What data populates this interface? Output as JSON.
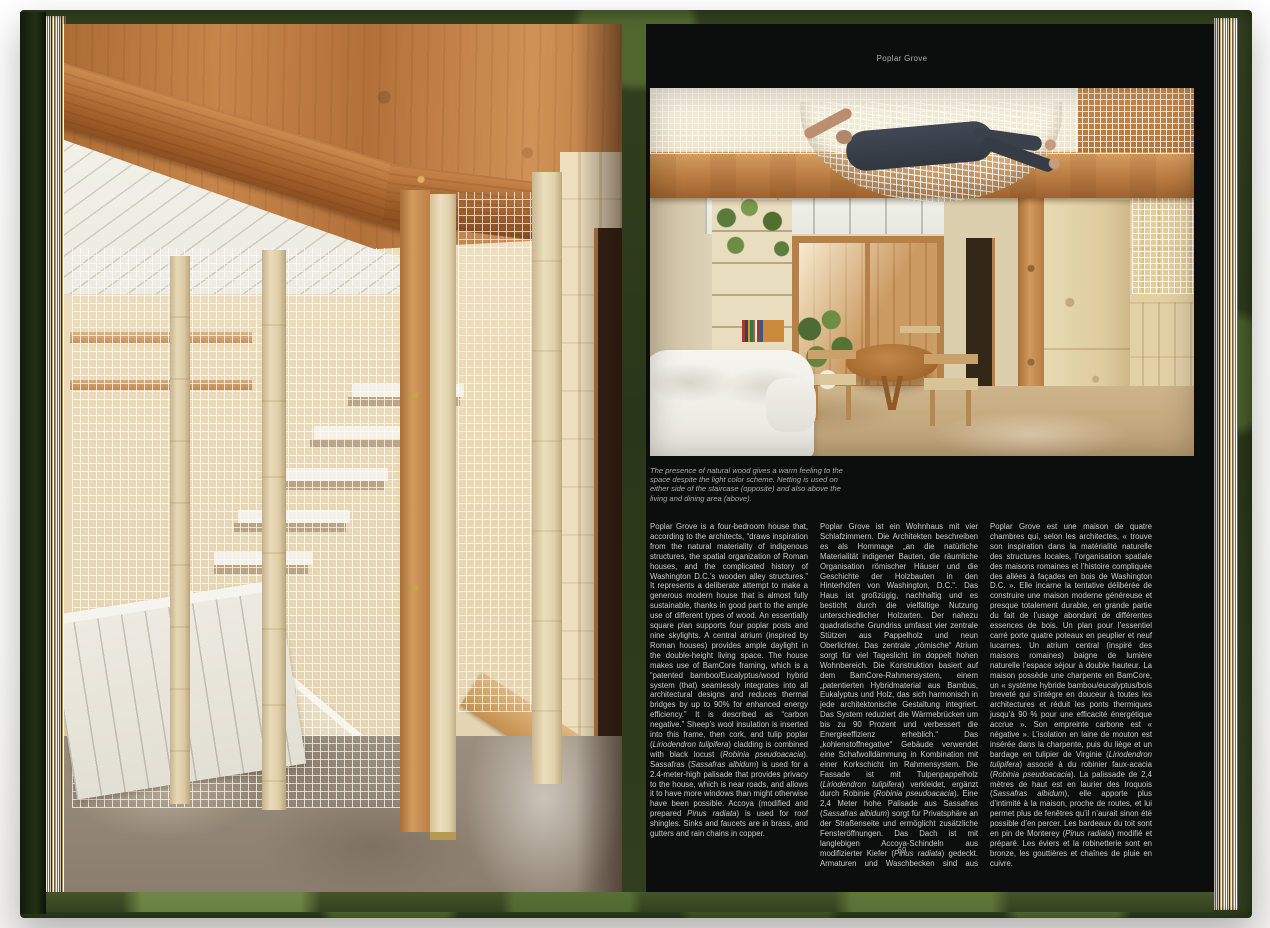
{
  "book": {
    "cover_color": "#31401f",
    "right_page": {
      "running_header": "Poplar Grove",
      "page_number": "69",
      "caption": "The presence of natural wood gives a warm feeling to the space despite the light color scheme. Netting is used on either side of the staircase (opposite) and also above the living and dining area (above).",
      "colors": {
        "page_background": "#0b0e0d",
        "body_text": "#c9cec9",
        "muted_text": "#9ba19c"
      },
      "columns": {
        "english": {
          "segments": [
            {
              "t": "Poplar Grove is a four-bedroom house that, according to the architects, “draws inspiration from the natural materiality of indigenous structures, the spatial organization of Roman houses, and the complicated history of Washington D.C.’s wooden alley structures.” It represents a deliberate attempt to make a generous modern house that is almost fully sustainable, thanks in good part to the ample use of different types of wood. An essentially square plan supports four poplar posts and nine skylights. A central atrium (inspired by Roman houses) provides ample daylight in the double-height living space. The house makes use of BamCore framing, which is a “patented bamboo/Eucalyptus/wood hybrid system (that) seamlessly integrates into all architectural designs and reduces thermal bridges by up to 90% for enhanced energy efficiency.” It is described as “carbon negative.” Sheep’s wool insulation is inserted into this frame, then cork, and tulip poplar ("
            },
            {
              "t": "Liriodendron tulipifera",
              "i": true
            },
            {
              "t": ") cladding is combined with black locust ("
            },
            {
              "t": "Robinia pseudoacacia",
              "i": true
            },
            {
              "t": "). Sassafras ("
            },
            {
              "t": "Sassafras albidum",
              "i": true
            },
            {
              "t": ") is used for a 2.4-meter-high palisade that provides privacy to the house, which is near roads, and allows it to have more windows than might otherwise have been possible. Accoya (modified and prepared "
            },
            {
              "t": "Pinus radiata",
              "i": true
            },
            {
              "t": ") is used for roof shingles. Sinks and faucets are in brass, and gutters and rain chains in copper."
            }
          ]
        },
        "german": {
          "segments": [
            {
              "t": "Poplar Grove ist ein Wohnhaus mit vier Schlafzimmern. Die Architekten beschreiben es als Hommage „an die natürliche Materialität indigener Bauten, die räumliche Organisation römischer Häuser und die Geschichte der Holzbauten in den Hinterhöfen von Washington, D.C.“. Das Haus ist großzügig, nachhaltig und es besticht durch die vielfältige Nutzung unterschiedlicher Holzarten. Der nahezu quadratische Grundriss umfasst vier zentrale Stützen aus Pappelholz und neun Oberlichter. Das zentrale „römische“ Atrium sorgt für viel Tageslicht im doppelt hohen Wohnbereich. Die Konstruktion basiert auf dem BamCore-Rahmensystem, einem „patentierten Hybridmaterial aus Bambus, Eukalyptus und Holz, das sich harmonisch in jede architektonische Gestaltung integriert. Das System reduziert die Wärmebrücken um bis zu 90 Prozent und verbessert die Energieeffizienz erheblich.“ Das „kohlenstoffnegative“ Gebäude verwendet eine Schafwolldämmung in Kombination mit einer Korkschicht im Rahmensystem. Die Fassade ist mit Tulpenpappelholz ("
            },
            {
              "t": "Liriodendron tulipifera",
              "i": true
            },
            {
              "t": ") verkleidet, ergänzt durch Robinie ("
            },
            {
              "t": "Robinia pseudoacacia",
              "i": true
            },
            {
              "t": "). Eine 2,4 Meter hohe Palisade aus Sassafras ("
            },
            {
              "t": "Sassafras albidum",
              "i": true
            },
            {
              "t": ") sorgt für Privatsphäre an der Straßenseite und ermöglicht zusätzliche Fensteröffnungen. Das Dach ist mit langlebigen Accoya-Schindeln aus modifizierter Kiefer ("
            },
            {
              "t": "Pinus radiata",
              "i": true
            },
            {
              "t": ") gedeckt. Armaturen und Waschbecken sind aus Messing, die Dachrinnen und Regenketten aus Kupfer gefertigt."
            }
          ]
        },
        "french": {
          "segments": [
            {
              "t": "Poplar Grove est une maison de quatre chambres qui, selon les architectes, « trouve son inspiration dans la matérialité naturelle des structures locales, l’organisation spatiale des maisons romaines et l’histoire compliquée des allées à façades en bois de Washington D.C. ». Elle incarne la tentative délibérée de construire une maison moderne généreuse et presque totalement durable, en grande partie du fait de l’usage abondant de différentes essences de bois. Un plan pour l’essentiel carré porte quatre poteaux en peuplier et neuf lucarnes. Un atrium central (inspiré des maisons romaines) baigne de lumière naturelle l’espace séjour à double hauteur. La maison possède une charpente en BamCore, un « système hybride bambou/eucalyptus/bois breveté qui s’intègre en douceur à toutes les architectures et réduit les ponts thermiques jusqu’à 90 % pour une efficacité énergétique accrue ». Son empreinte carbone est « négative ». L’isolation en laine de mouton est insérée dans la charpente, puis du liège et un bardage en tulipier de Virginie ("
            },
            {
              "t": "Liriodendron tulipifera",
              "i": true
            },
            {
              "t": ") associé à du robinier faux-acacia ("
            },
            {
              "t": "Robinia pseudoacacia",
              "i": true
            },
            {
              "t": "). La palissade de 2,4 mètres de haut est en laurier des Iroquois ("
            },
            {
              "t": "Sassafras albidum",
              "i": true
            },
            {
              "t": "), elle apporte plus d’intimité à la maison, proche de routes, et lui permet plus de fenêtres qu’il n’aurait sinon été possible d’en percer. Les bardeaux du toit sont en pin de Monterey ("
            },
            {
              "t": "Pinus radiata",
              "i": true
            },
            {
              "t": ") modifié et préparé. Les éviers et la robinetterie sont en bronze, les gouttières et chaînes de pluie en cuivre."
            }
          ]
        }
      }
    }
  }
}
